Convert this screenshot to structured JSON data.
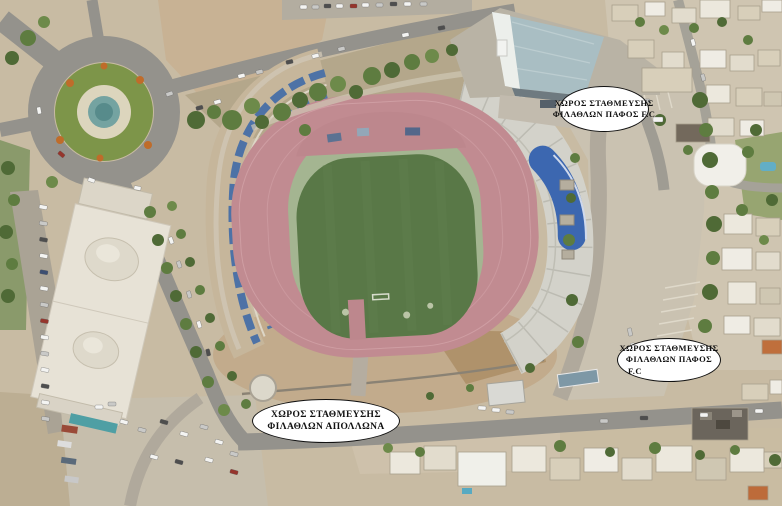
{
  "annotations": {
    "pafos_fc_top": {
      "line1": "ΧΩΡΟΣ ΣΤΑΘΜΕΥΣΗΣ",
      "line2": "ΦΙΛΑΘΛΩΝ ΠΑΦΟΣ F.C"
    },
    "pafos_fc_right": {
      "line1": "ΧΩΡΟΣ ΣΤΑΘΜΕΥΣΗΣ",
      "line2": "ΦΙΛΑΘΛΩΝ  ΠΑΦΟΣ",
      "line3": "F.C"
    },
    "apollona_bottom": {
      "line1": "ΧΩΡΟΣ ΣΤΑΘΜΕΥΣΗΣ",
      "line2": "ΦΙΛΑΘΛΩΝ ΑΠΟΛΛΩΝΑ"
    }
  },
  "colors": {
    "ground": "#c8bba3",
    "dirt": "#c4ae8f",
    "road": "#94928c",
    "running_track": "#c18b91",
    "grass_field": "#597847",
    "infield_faded": "#a4b591",
    "west_stand_blue": "#4d72a6",
    "east_stand_concrete": "#d3d2ca",
    "vip_canopy_blue": "#3c67b0",
    "sports_hall_roof": "#a9bec3",
    "white_building": "#e7e2d6",
    "roundabout_green": "#7d9549",
    "fountain_teal": "#74a3a1",
    "label_background": "#ffffff",
    "label_border": "#111111"
  }
}
